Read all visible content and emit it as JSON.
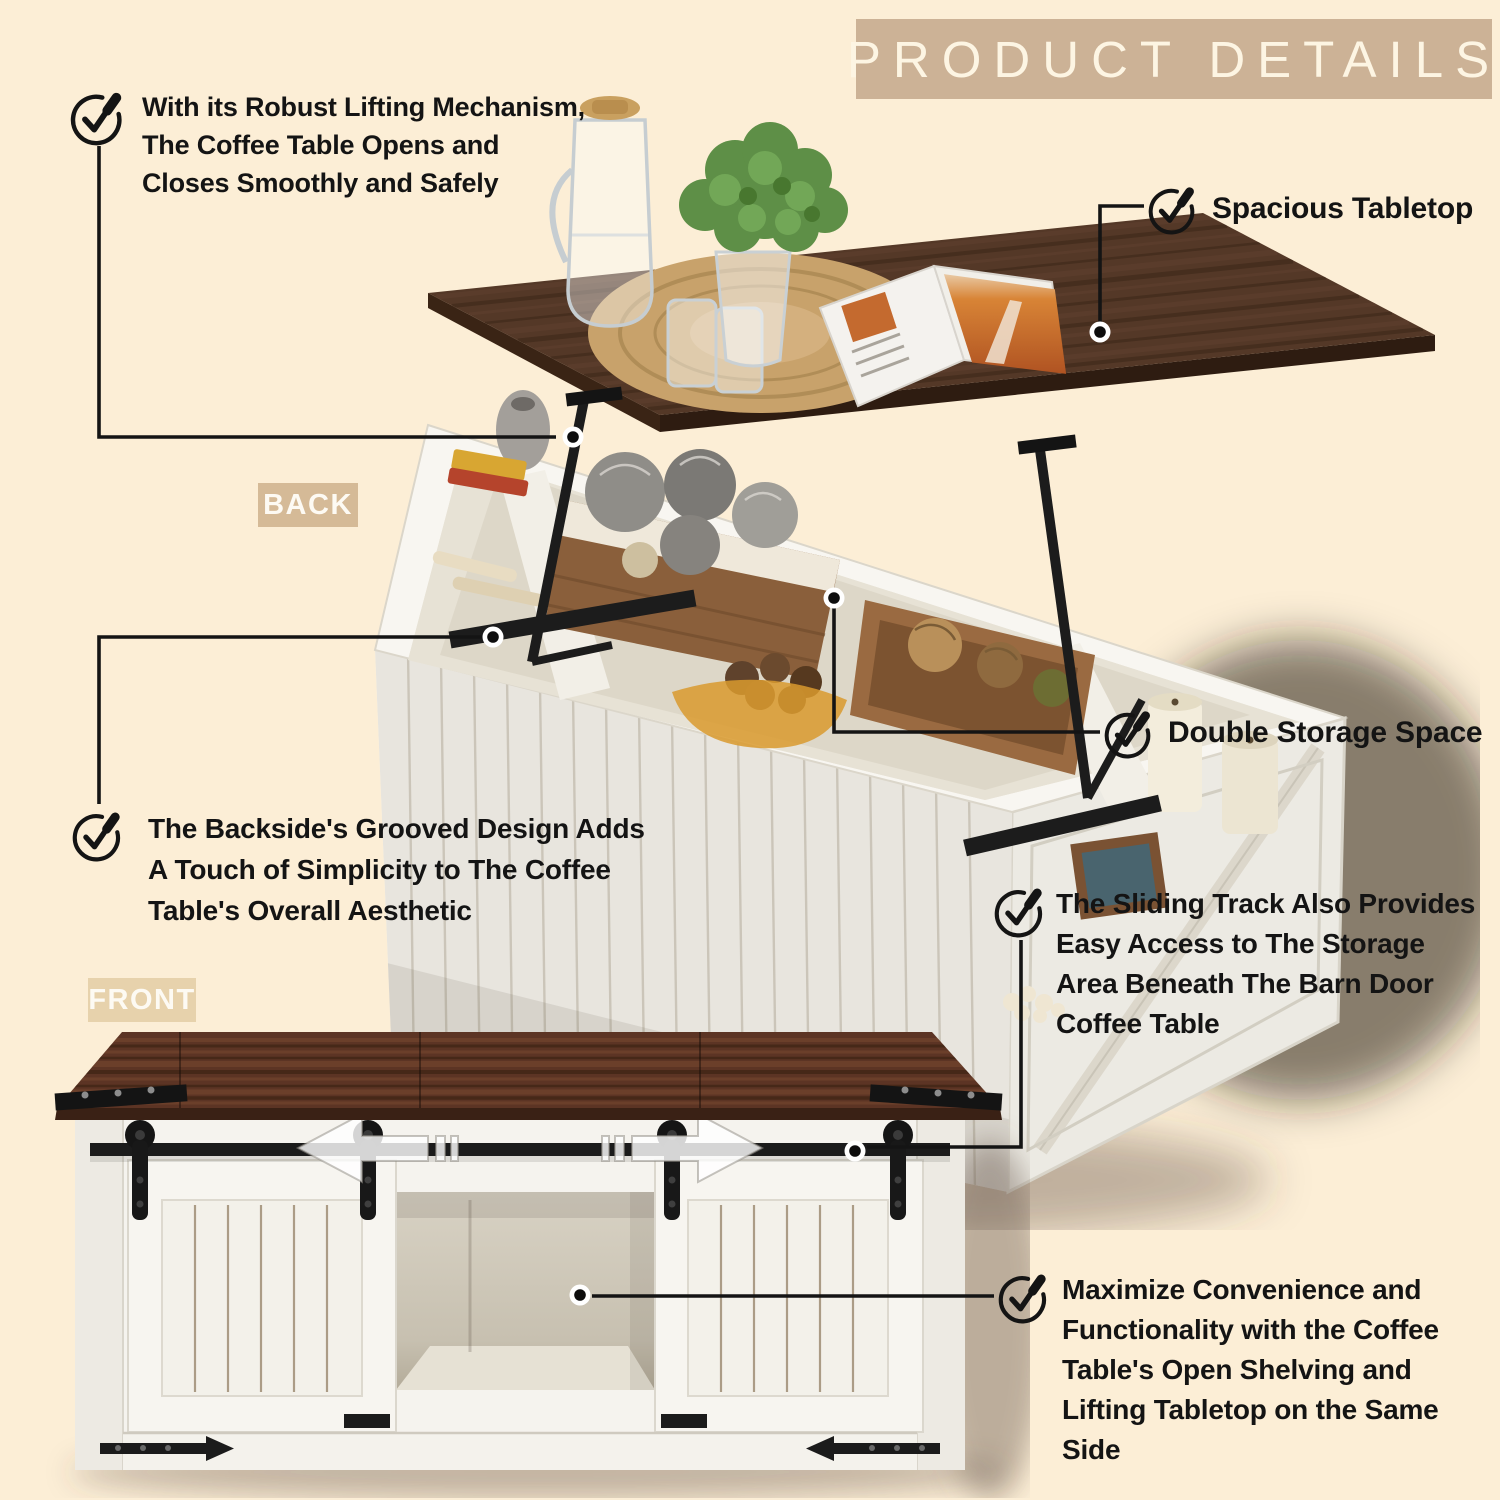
{
  "page": {
    "background": "#fceed6",
    "width": 1500,
    "height": 1500
  },
  "header": {
    "title": "PRODUCT DETAILS",
    "bg": "#ccb296",
    "text_color": "#fdf5e3"
  },
  "view_labels": {
    "back": "BACK",
    "front": "FRONT"
  },
  "callouts": {
    "lifting": {
      "lines": [
        "With its Robust Lifting Mechanism,",
        "The Coffee Table Opens and",
        "Closes Smoothly and Safely"
      ]
    },
    "tabletop": {
      "lines": [
        "Spacious Tabletop"
      ]
    },
    "storage": {
      "lines": [
        "Double Storage Space"
      ]
    },
    "grooved": {
      "lines": [
        "The Backside's Grooved Design Adds",
        "A Touch of Simplicity to The Coffee",
        "Table's Overall Aesthetic"
      ]
    },
    "sliding": {
      "lines": [
        "The Sliding Track Also Provides",
        "Easy Access to The Storage",
        "Area Beneath The Barn Door",
        "Coffee Table"
      ]
    },
    "shelving": {
      "lines": [
        "Maximize Convenience and",
        "Functionality with the Coffee",
        "Table's Open Shelving and",
        "Lifting Tabletop on the Same",
        "Side"
      ]
    }
  },
  "colors": {
    "text": "#141414",
    "callout_line": "#141414",
    "wood_top": "#57331f",
    "wood_front": "#5c3424",
    "furniture_white": "#f5f3ee",
    "hardware_black": "#1b1b1b",
    "label_back_bg": "#d5ba97",
    "label_front_bg": "#e7d2ac",
    "magazine_orange": "#cf6a2b",
    "plant_green": "#5e8f47"
  }
}
